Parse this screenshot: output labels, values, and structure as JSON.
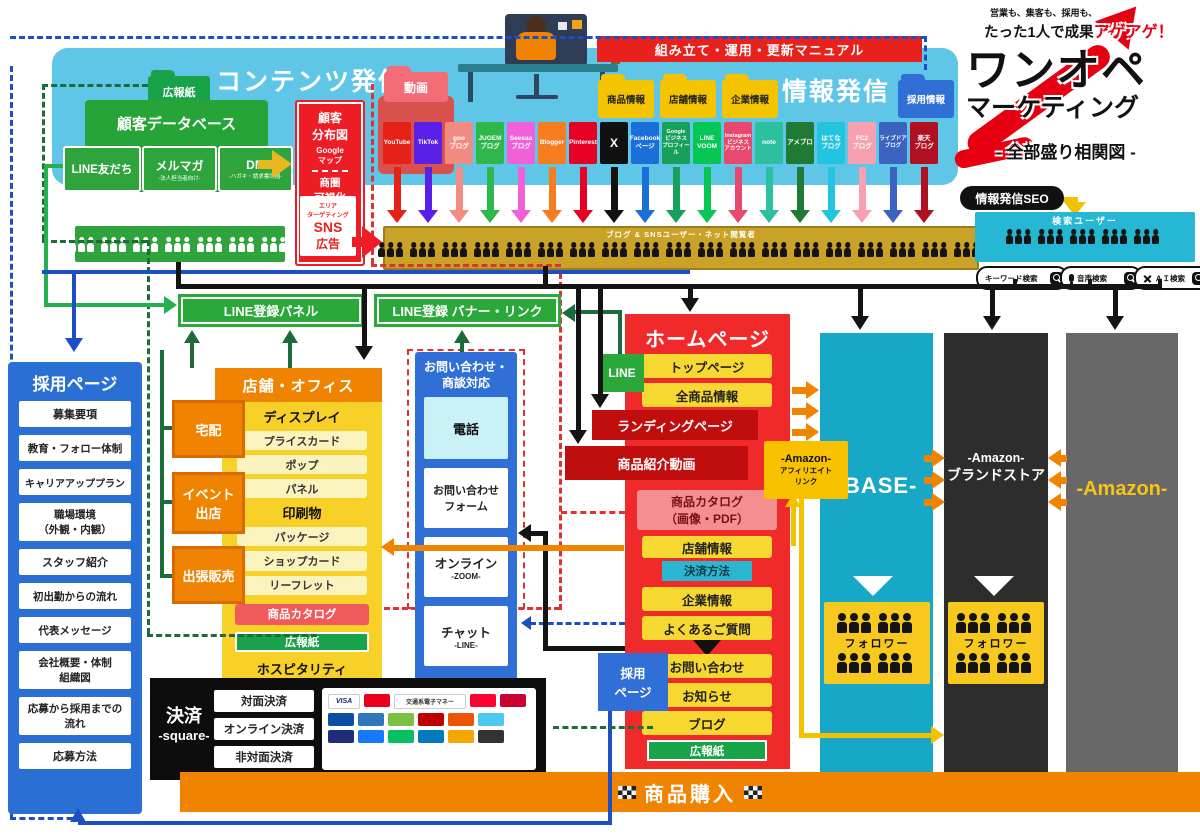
{
  "brand": {
    "tagline_top": "営業も、集客も、採用も、",
    "tagline_main": "たった1人で成果",
    "tagline_accent": "アゲアゲ！",
    "title_line1": "ワンオペ",
    "title_line2": "マーケティング",
    "subtitle": "- 全部盛り相関図 -",
    "accent_red": "#e60012"
  },
  "content_panel": {
    "title": "コンテンツ発信",
    "koho_folder": "広報紙",
    "database": {
      "title": "顧客データベース",
      "items": [
        {
          "label": "LINE友だち",
          "sub": ""
        },
        {
          "label": "メルマガ",
          "sub": "-法人担当者向け-"
        },
        {
          "label": "DM",
          "sub": "-ハガキ・請求書同梱-"
        }
      ]
    },
    "bunpu": {
      "line1": "顧客",
      "line2": "分布図",
      "google1": "Google",
      "google2": "マップ",
      "shoken1": "商圏",
      "shoken2": "可視化",
      "area1": "エリア",
      "area2": "ターゲティング",
      "sns": "SNS",
      "ad": "広告"
    }
  },
  "manual_bar": "組み立て・運用・更新マニュアル",
  "info_panel": {
    "title": "情報発信",
    "folders": [
      "商品情報",
      "店舗情報",
      "企業情報"
    ],
    "recruit_folder": "採用情報",
    "video_folder": "動画"
  },
  "sns_tiles": [
    {
      "label": "YouTube",
      "color": "#e62117"
    },
    {
      "label": "TikTok",
      "color": "#5a20e8"
    },
    {
      "label": "goo\nブログ",
      "color": "#f28b82"
    },
    {
      "label": "JUGEM\nブログ",
      "color": "#2eb84b"
    },
    {
      "label": "Seesaa\nブログ",
      "color": "#f060d8"
    },
    {
      "label": "Blogger",
      "color": "#f57d20"
    },
    {
      "label": "Pinterest",
      "color": "#e60023"
    },
    {
      "label": "X",
      "color": "#111111"
    },
    {
      "label": "Facebook\nページ",
      "color": "#1b6fd8"
    },
    {
      "label": "Google\nビジネス\nプロフィール",
      "color": "#17a05a"
    },
    {
      "label": "LINE\nVOOM",
      "color": "#06c755"
    },
    {
      "label": "Instagram\nビジネス\nアカウント",
      "color": "#e8486c"
    },
    {
      "label": "note",
      "color": "#2cc0a0"
    },
    {
      "label": "アメブロ",
      "color": "#1e7a34"
    },
    {
      "label": "はてな\nブログ",
      "color": "#22c4e0"
    },
    {
      "label": "FC2\nブログ",
      "color": "#f7a0b0"
    },
    {
      "label": "ライブドア\nブログ",
      "color": "#3a64c0"
    },
    {
      "label": "楽天\nブログ",
      "color": "#b01020"
    }
  ],
  "users_bar": "ブログ & SNSユーザー・ネット閲覧者",
  "seo_pill": "情報発信SEO",
  "search_panel": {
    "title": "検索ユーザー",
    "pills": [
      "キーワード検索",
      "音声検索",
      "ＡＩ検索"
    ]
  },
  "line_register": {
    "panel": "LINE登録パネル",
    "banner": "LINE登録 バナー・リンク",
    "chip": "LINE"
  },
  "recruit_page": {
    "title": "採用ページ",
    "items": [
      "募集要項",
      "教育・フォロー体制",
      "キャリアアッププラン",
      "職場環境\n（外観・内観）",
      "スタッフ紹介",
      "初出勤からの流れ",
      "代表メッセージ",
      "会社概要・体制\n組織図",
      "応募から採用までの\n流れ",
      "応募方法"
    ]
  },
  "store": {
    "title": "店舗・オフィス",
    "side_items": [
      "宅配",
      "イベント\n出店",
      "出張販売"
    ],
    "display_title": "ディスプレイ",
    "display_items": [
      "プライスカード",
      "ポップ",
      "パネル"
    ],
    "print_title": "印刷物",
    "print_items": [
      "パッケージ",
      "ショップカード",
      "リーフレット"
    ],
    "catalog": "商品カタログ",
    "koho": "広報紙",
    "footer": "ホスピタリティ"
  },
  "contact": {
    "title": "お問い合わせ・\n商談対応",
    "phone": "電話",
    "form": "お問い合わせ\nフォーム",
    "online": "オンライン",
    "online_sub": "-ZOOM-",
    "chat": "チャット",
    "chat_sub": "-LINE-"
  },
  "homepage": {
    "title": "ホームページ",
    "items": [
      "トップページ",
      "全商品情報",
      "ランディングページ",
      "商品紹介動画",
      "商品カタログ\n（画像・PDF）",
      "店舗情報",
      "決済方法",
      "企業情報",
      "よくあるご質問",
      "お問い合わせ",
      "お知らせ",
      "ブログ",
      "広報紙"
    ]
  },
  "affiliate": {
    "line1": "-Amazon-",
    "line2": "アフィリエイト",
    "line3": "リンク"
  },
  "shops": {
    "base": "-BASE-",
    "brand_line1": "-Amazon-",
    "brand_line2": "ブランドストア",
    "amazon": "-Amazon-",
    "follower": "フォロワー"
  },
  "recruit_chip": "採用\nページ",
  "payment": {
    "title": "決済",
    "subtitle": "-square-",
    "methods": [
      "対面決済",
      "オンライン決済",
      "非対面決済"
    ],
    "visa": "VISA",
    "transit": "交通系電子マネー"
  },
  "purchase_bar": "商品購入",
  "colors": {
    "sky": "#5fc6e8",
    "green": "#27a437",
    "red": "#ee1c25",
    "gold": "#c9a227",
    "blue": "#2a6fd4",
    "orange": "#f08300",
    "yellow": "#f7d831",
    "dark_red": "#c00d0d",
    "teal": "#17a8c8",
    "dark": "#2d2d2d",
    "gray": "#686868",
    "amazon_yellow": "#f5c518"
  }
}
